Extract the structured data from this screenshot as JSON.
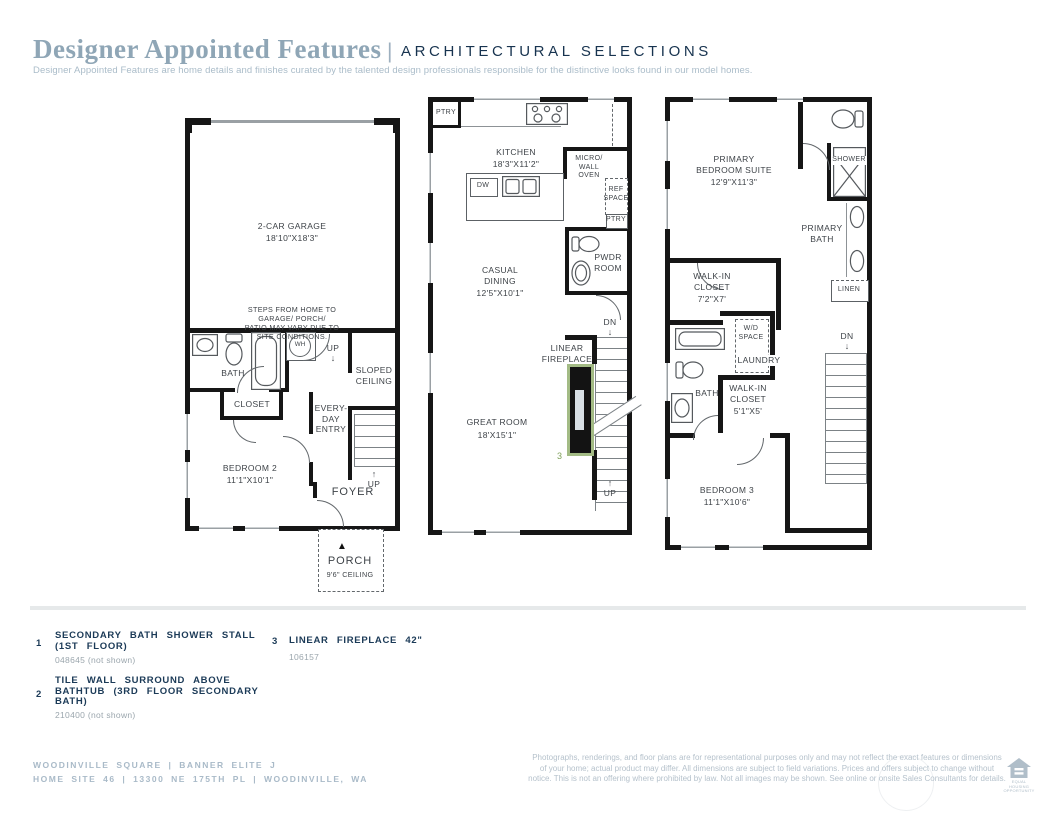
{
  "icons": {
    "up_arrow": "↑",
    "down_arrow": "↓",
    "porch_marker": "▲"
  },
  "header": {
    "title": "Designer Appointed Features",
    "divider": "|",
    "category": "ARCHITECTURAL SELECTIONS",
    "description": "Designer Appointed Features are home details and finishes curated by the talented design professionals responsible for the distinctive looks found in our model homes."
  },
  "plan1": {
    "garage_name": "2-CAR GARAGE",
    "garage_dims": "18'10\"X18'3\"",
    "site_note": "STEPS FROM HOME TO GARAGE/ PORCH/\nPATIO MAY VARY DUE TO SITE CONDITIONS.",
    "wh": "WH",
    "up_top": "UP",
    "bath": "BATH",
    "sloped_ceiling": "SLOPED\nCEILING",
    "closet": "CLOSET",
    "everyday_entry": "EVERY-\nDAY\nENTRY",
    "bedroom_name": "BEDROOM 2",
    "bedroom_dims": "11'1\"X10'1\"",
    "up_stairs": "UP",
    "foyer": "FOYER",
    "porch_name": "PORCH",
    "porch_ceiling": "9'6\" CEILING"
  },
  "plan2": {
    "pantry_top": "PTRY",
    "kitchen_name": "KITCHEN",
    "kitchen_dims": "18'3\"X11'2\"",
    "dishwasher": "DW",
    "micro_wall_oven": "MICRO/\nWALL\nOVEN",
    "ref_space": "REF\nSPACE",
    "pantry_small": "PTRY",
    "powder_room": "PWDR\nROOM",
    "dining_name": "CASUAL\nDINING",
    "dining_dims": "12'5\"X10'1\"",
    "dn": "DN",
    "fireplace_label": "LINEAR\nFIREPLACE",
    "fireplace_marker": "3",
    "great_room_name": "GREAT ROOM",
    "great_room_dims": "18'X15'1\"",
    "up": "UP"
  },
  "plan3": {
    "suite_name": "PRIMARY\nBEDROOM SUITE",
    "suite_dims": "12'9\"X11'3\"",
    "shower": "SHOWER",
    "primary_bath": "PRIMARY\nBATH",
    "walkin1_name": "WALK-IN\nCLOSET",
    "walkin1_dims": "7'2\"X7'",
    "linen": "LINEN",
    "wd_space": "W/D\nSPACE",
    "laundry": "LAUNDRY",
    "bath": "BATH",
    "walkin2_name": "WALK-IN\nCLOSET",
    "walkin2_dims": "5'1\"X5'",
    "dn": "DN",
    "bedroom_name": "BEDROOM 3",
    "bedroom_dims": "11'1\"X10'6\""
  },
  "legend": {
    "items": [
      {
        "num": "1",
        "title": "SECONDARY BATH SHOWER STALL\n(1ST FLOOR)",
        "code": "048645 (not shown)"
      },
      {
        "num": "2",
        "title": "TILE WALL SURROUND ABOVE\nBATHTUB (3RD FLOOR SECONDARY\nBATH)",
        "code": "210400 (not shown)"
      },
      {
        "num": "3",
        "title": "LINEAR FIREPLACE 42\"",
        "code": "106157"
      }
    ]
  },
  "footer": {
    "community_line": "WOODINVILLE SQUARE | BANNER ELITE J",
    "address_line": "HOME SITE 46 | 13300 NE 175TH PL | WOODINVILLE, WA",
    "disclaimer": "Photographs, renderings, and floor plans are for representational purposes only and may not reflect the exact features or dimensions of your home; actual product may differ. All dimensions are subject to field variations. Prices and offers subject to change without notice. This is not an offering where prohibited by law. Not all images may be shown. See online or onsite Sales Consultants for details.",
    "equal_housing": "EQUAL HOUSING\nOPPORTUNITY"
  }
}
